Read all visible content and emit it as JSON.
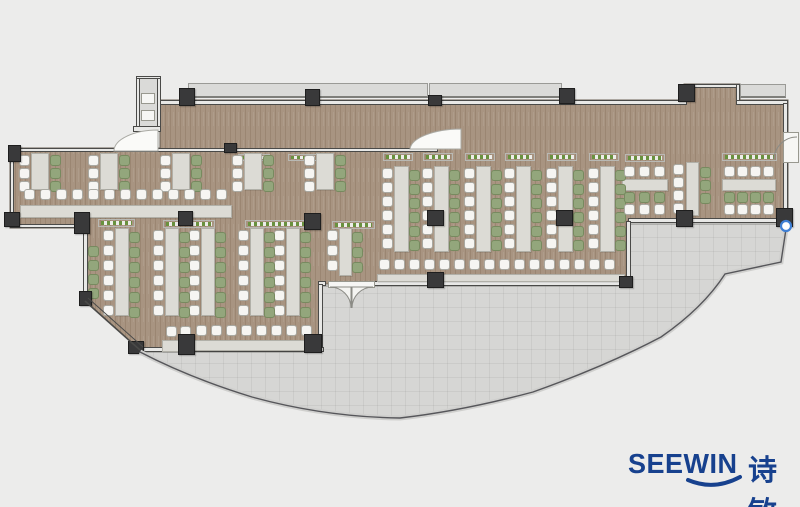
{
  "logo": {
    "brand": "SEEWIN",
    "brand_cn": "诗敏",
    "color": "#17418e"
  },
  "colors": {
    "background": "#ececeb",
    "floor": "#a89481",
    "terrace": "#d6d6d4",
    "wall": "#4a4a48",
    "column": "#39393a",
    "table": "#dcdbd5",
    "chair_white": "#f6f5f2",
    "chair_green": "#93a67c",
    "plant_green": "#69913e",
    "marker_blue": "#3f7fd4"
  },
  "plan": {
    "paths": {
      "floor": "M160,100 H684 V84 H740 V100 H788 V221 H628 V284 H322 V350 H140 L85,301 V228 H10 V148 H160 Z",
      "terrace": "M140,352 H318 V286 H628 V224 H786 V230 L780,262 L724,274 Q702,308 660,337 Q605,366 533,392 Q460,410 400,418 Q325,416 252,397 Q190,378 140,352 Z",
      "parapet": "M140,352 Q190,378 252,397 Q325,417 400,418 Q462,411 533,392 Q606,366 661,337 Q703,308 725,274 L781,262 L786,229",
      "diagonal_wall_a": "M85,301 L140,350",
      "diagonal_wall_b": "M88,298 L143,347",
      "door_terrace_left": "M330,287 A21,21 0 0 1 351,308 L351,287 Z",
      "door_terrace_right": "M373,287 A21,21 0 0 0 352,308 L352,287 Z",
      "door_lobby_wedge": "M410,149 L461,149 L461,129 A52,21 0 0 0 410,149 Z",
      "door_elevator_wedge": "M158,151 L114,151 A44,21 0 0 1 158,130 Z",
      "door_right_arc": "M797,137 A23,23 0 0 0 774,160",
      "logo_smile": "M688,480 Q714,491 740,477"
    },
    "blue_marker": {
      "x": 786,
      "y": 226,
      "r": 5
    },
    "ledges": [
      [
        188,
        83,
        240,
        15
      ],
      [
        429,
        83,
        133,
        15
      ],
      [
        740,
        84,
        46,
        14
      ],
      [
        136,
        78,
        25,
        50
      ]
    ],
    "walls": [
      [
        160,
        100,
        527,
        5
      ],
      [
        684,
        84,
        5,
        17
      ],
      [
        684,
        84,
        56,
        4
      ],
      [
        736,
        84,
        4,
        17
      ],
      [
        736,
        100,
        52,
        5
      ],
      [
        783,
        103,
        5,
        31
      ],
      [
        783,
        160,
        5,
        58
      ],
      [
        628,
        218,
        160,
        5
      ],
      [
        626,
        221,
        5,
        64
      ],
      [
        374,
        281,
        256,
        5
      ],
      [
        318,
        281,
        8,
        5
      ],
      [
        318,
        284,
        5,
        68
      ],
      [
        140,
        347,
        184,
        5
      ],
      [
        12,
        148,
        426,
        4
      ],
      [
        10,
        150,
        4,
        78
      ],
      [
        10,
        224,
        75,
        4
      ],
      [
        83,
        226,
        5,
        77
      ],
      [
        136,
        76,
        25,
        3
      ],
      [
        136,
        78,
        4,
        51
      ],
      [
        157,
        78,
        4,
        51
      ],
      [
        133,
        126,
        28,
        6
      ]
    ],
    "planters": [
      [
        383,
        153,
        30,
        8
      ],
      [
        423,
        153,
        30,
        8
      ],
      [
        465,
        153,
        30,
        8
      ],
      [
        505,
        153,
        30,
        8
      ],
      [
        547,
        153,
        30,
        8
      ],
      [
        589,
        153,
        30,
        8
      ],
      [
        625,
        154,
        40,
        8
      ],
      [
        722,
        153,
        55,
        8
      ],
      [
        98,
        219,
        37,
        8
      ],
      [
        163,
        220,
        52,
        8
      ],
      [
        245,
        220,
        63,
        8
      ],
      [
        332,
        221,
        43,
        8
      ],
      [
        238,
        154,
        32,
        7
      ],
      [
        288,
        154,
        30,
        7
      ]
    ],
    "tables": [
      [
        31,
        153,
        18,
        37
      ],
      [
        100,
        153,
        18,
        37
      ],
      [
        172,
        153,
        18,
        37
      ],
      [
        244,
        153,
        18,
        37
      ],
      [
        316,
        153,
        18,
        37
      ],
      [
        115,
        228,
        14,
        88
      ],
      [
        165,
        228,
        14,
        88
      ],
      [
        201,
        228,
        14,
        88
      ],
      [
        250,
        228,
        14,
        88
      ],
      [
        286,
        228,
        14,
        88
      ],
      [
        339,
        228,
        13,
        48
      ],
      [
        394,
        166,
        15,
        86
      ],
      [
        434,
        166,
        15,
        86
      ],
      [
        476,
        166,
        15,
        86
      ],
      [
        516,
        166,
        15,
        86
      ],
      [
        558,
        166,
        15,
        86
      ],
      [
        600,
        166,
        15,
        86
      ],
      [
        622,
        179,
        46,
        12
      ],
      [
        686,
        162,
        13,
        54
      ],
      [
        722,
        179,
        54,
        12
      ],
      [
        20,
        205,
        212,
        13
      ],
      [
        193,
        340,
        122,
        11
      ],
      [
        162,
        340,
        28,
        12
      ],
      [
        377,
        274,
        248,
        8
      ]
    ],
    "panels": [
      [
        141,
        93,
        14,
        11
      ],
      [
        141,
        110,
        14,
        11
      ],
      [
        328,
        281,
        47,
        7
      ],
      [
        783,
        132,
        16,
        31
      ]
    ],
    "chair_runs": [
      {
        "x": 19,
        "y": 155,
        "n": 3,
        "dir": "v",
        "col": "w",
        "gap": 13
      },
      {
        "x": 88,
        "y": 155,
        "n": 3,
        "dir": "v",
        "col": "w",
        "gap": 13
      },
      {
        "x": 160,
        "y": 155,
        "n": 3,
        "dir": "v",
        "col": "w",
        "gap": 13
      },
      {
        "x": 232,
        "y": 155,
        "n": 3,
        "dir": "v",
        "col": "w",
        "gap": 13
      },
      {
        "x": 304,
        "y": 155,
        "n": 3,
        "dir": "v",
        "col": "w",
        "gap": 13
      },
      {
        "x": 50,
        "y": 155,
        "n": 3,
        "dir": "v",
        "col": "g",
        "gap": 13
      },
      {
        "x": 119,
        "y": 155,
        "n": 3,
        "dir": "v",
        "col": "g",
        "gap": 13
      },
      {
        "x": 191,
        "y": 155,
        "n": 3,
        "dir": "v",
        "col": "g",
        "gap": 13
      },
      {
        "x": 263,
        "y": 155,
        "n": 3,
        "dir": "v",
        "col": "g",
        "gap": 13
      },
      {
        "x": 335,
        "y": 155,
        "n": 3,
        "dir": "v",
        "col": "g",
        "gap": 13
      },
      {
        "x": 103,
        "y": 230,
        "n": 6,
        "dir": "v",
        "col": "w",
        "gap": 15
      },
      {
        "x": 153,
        "y": 230,
        "n": 6,
        "dir": "v",
        "col": "w",
        "gap": 15
      },
      {
        "x": 189,
        "y": 230,
        "n": 6,
        "dir": "v",
        "col": "w",
        "gap": 15
      },
      {
        "x": 238,
        "y": 230,
        "n": 6,
        "dir": "v",
        "col": "w",
        "gap": 15
      },
      {
        "x": 274,
        "y": 230,
        "n": 6,
        "dir": "v",
        "col": "w",
        "gap": 15
      },
      {
        "x": 129,
        "y": 232,
        "n": 6,
        "dir": "v",
        "col": "g",
        "gap": 15
      },
      {
        "x": 179,
        "y": 232,
        "n": 6,
        "dir": "v",
        "col": "g",
        "gap": 15
      },
      {
        "x": 215,
        "y": 232,
        "n": 6,
        "dir": "v",
        "col": "g",
        "gap": 15
      },
      {
        "x": 264,
        "y": 232,
        "n": 6,
        "dir": "v",
        "col": "g",
        "gap": 15
      },
      {
        "x": 300,
        "y": 232,
        "n": 6,
        "dir": "v",
        "col": "g",
        "gap": 15
      },
      {
        "x": 327,
        "y": 230,
        "n": 3,
        "dir": "v",
        "col": "w",
        "gap": 15
      },
      {
        "x": 352,
        "y": 232,
        "n": 3,
        "dir": "v",
        "col": "g",
        "gap": 15
      },
      {
        "x": 88,
        "y": 246,
        "n": 4,
        "dir": "v",
        "col": "g",
        "gap": 14
      },
      {
        "x": 382,
        "y": 168,
        "n": 6,
        "dir": "v",
        "col": "w",
        "gap": 14
      },
      {
        "x": 422,
        "y": 168,
        "n": 6,
        "dir": "v",
        "col": "w",
        "gap": 14
      },
      {
        "x": 464,
        "y": 168,
        "n": 6,
        "dir": "v",
        "col": "w",
        "gap": 14
      },
      {
        "x": 504,
        "y": 168,
        "n": 6,
        "dir": "v",
        "col": "w",
        "gap": 14
      },
      {
        "x": 546,
        "y": 168,
        "n": 6,
        "dir": "v",
        "col": "w",
        "gap": 14
      },
      {
        "x": 588,
        "y": 168,
        "n": 6,
        "dir": "v",
        "col": "w",
        "gap": 14
      },
      {
        "x": 409,
        "y": 170,
        "n": 6,
        "dir": "v",
        "col": "g",
        "gap": 14
      },
      {
        "x": 449,
        "y": 170,
        "n": 6,
        "dir": "v",
        "col": "g",
        "gap": 14
      },
      {
        "x": 491,
        "y": 170,
        "n": 6,
        "dir": "v",
        "col": "g",
        "gap": 14
      },
      {
        "x": 531,
        "y": 170,
        "n": 6,
        "dir": "v",
        "col": "g",
        "gap": 14
      },
      {
        "x": 573,
        "y": 170,
        "n": 6,
        "dir": "v",
        "col": "g",
        "gap": 14
      },
      {
        "x": 615,
        "y": 170,
        "n": 6,
        "dir": "v",
        "col": "g",
        "gap": 14
      },
      {
        "x": 624,
        "y": 166,
        "n": 3,
        "dir": "h",
        "col": "w",
        "gap": 15
      },
      {
        "x": 624,
        "y": 192,
        "n": 3,
        "dir": "h",
        "col": "g",
        "gap": 15
      },
      {
        "x": 624,
        "y": 204,
        "n": 3,
        "dir": "h",
        "col": "w",
        "gap": 15
      },
      {
        "x": 673,
        "y": 164,
        "n": 4,
        "dir": "v",
        "col": "w",
        "gap": 13
      },
      {
        "x": 700,
        "y": 167,
        "n": 3,
        "dir": "v",
        "col": "g",
        "gap": 13
      },
      {
        "x": 724,
        "y": 166,
        "n": 4,
        "dir": "h",
        "col": "w",
        "gap": 13
      },
      {
        "x": 724,
        "y": 192,
        "n": 4,
        "dir": "h",
        "col": "g",
        "gap": 13
      },
      {
        "x": 724,
        "y": 204,
        "n": 4,
        "dir": "h",
        "col": "w",
        "gap": 13
      },
      {
        "x": 24,
        "y": 189,
        "n": 13,
        "dir": "h",
        "col": "w",
        "gap": 16
      },
      {
        "x": 196,
        "y": 325,
        "n": 8,
        "dir": "h",
        "col": "w",
        "gap": 15
      },
      {
        "x": 166,
        "y": 326,
        "n": 2,
        "dir": "h",
        "col": "w",
        "gap": 14
      },
      {
        "x": 379,
        "y": 259,
        "n": 16,
        "dir": "h",
        "col": "w",
        "gap": 15
      }
    ],
    "columns": [
      [
        8,
        145,
        13,
        17
      ],
      [
        179,
        88,
        16,
        18
      ],
      [
        305,
        89,
        15,
        17
      ],
      [
        428,
        95,
        14,
        11
      ],
      [
        559,
        88,
        16,
        16
      ],
      [
        678,
        84,
        17,
        18
      ],
      [
        776,
        208,
        17,
        19
      ],
      [
        676,
        210,
        17,
        17
      ],
      [
        619,
        276,
        14,
        12
      ],
      [
        427,
        272,
        17,
        16
      ],
      [
        304,
        334,
        18,
        19
      ],
      [
        178,
        334,
        17,
        21
      ],
      [
        128,
        341,
        16,
        13
      ],
      [
        79,
        291,
        13,
        15
      ],
      [
        4,
        212,
        16,
        15
      ],
      [
        74,
        212,
        16,
        22
      ],
      [
        427,
        210,
        17,
        16
      ],
      [
        556,
        210,
        17,
        16
      ],
      [
        178,
        211,
        15,
        15
      ],
      [
        304,
        213,
        17,
        17
      ],
      [
        224,
        143,
        13,
        10
      ]
    ]
  }
}
